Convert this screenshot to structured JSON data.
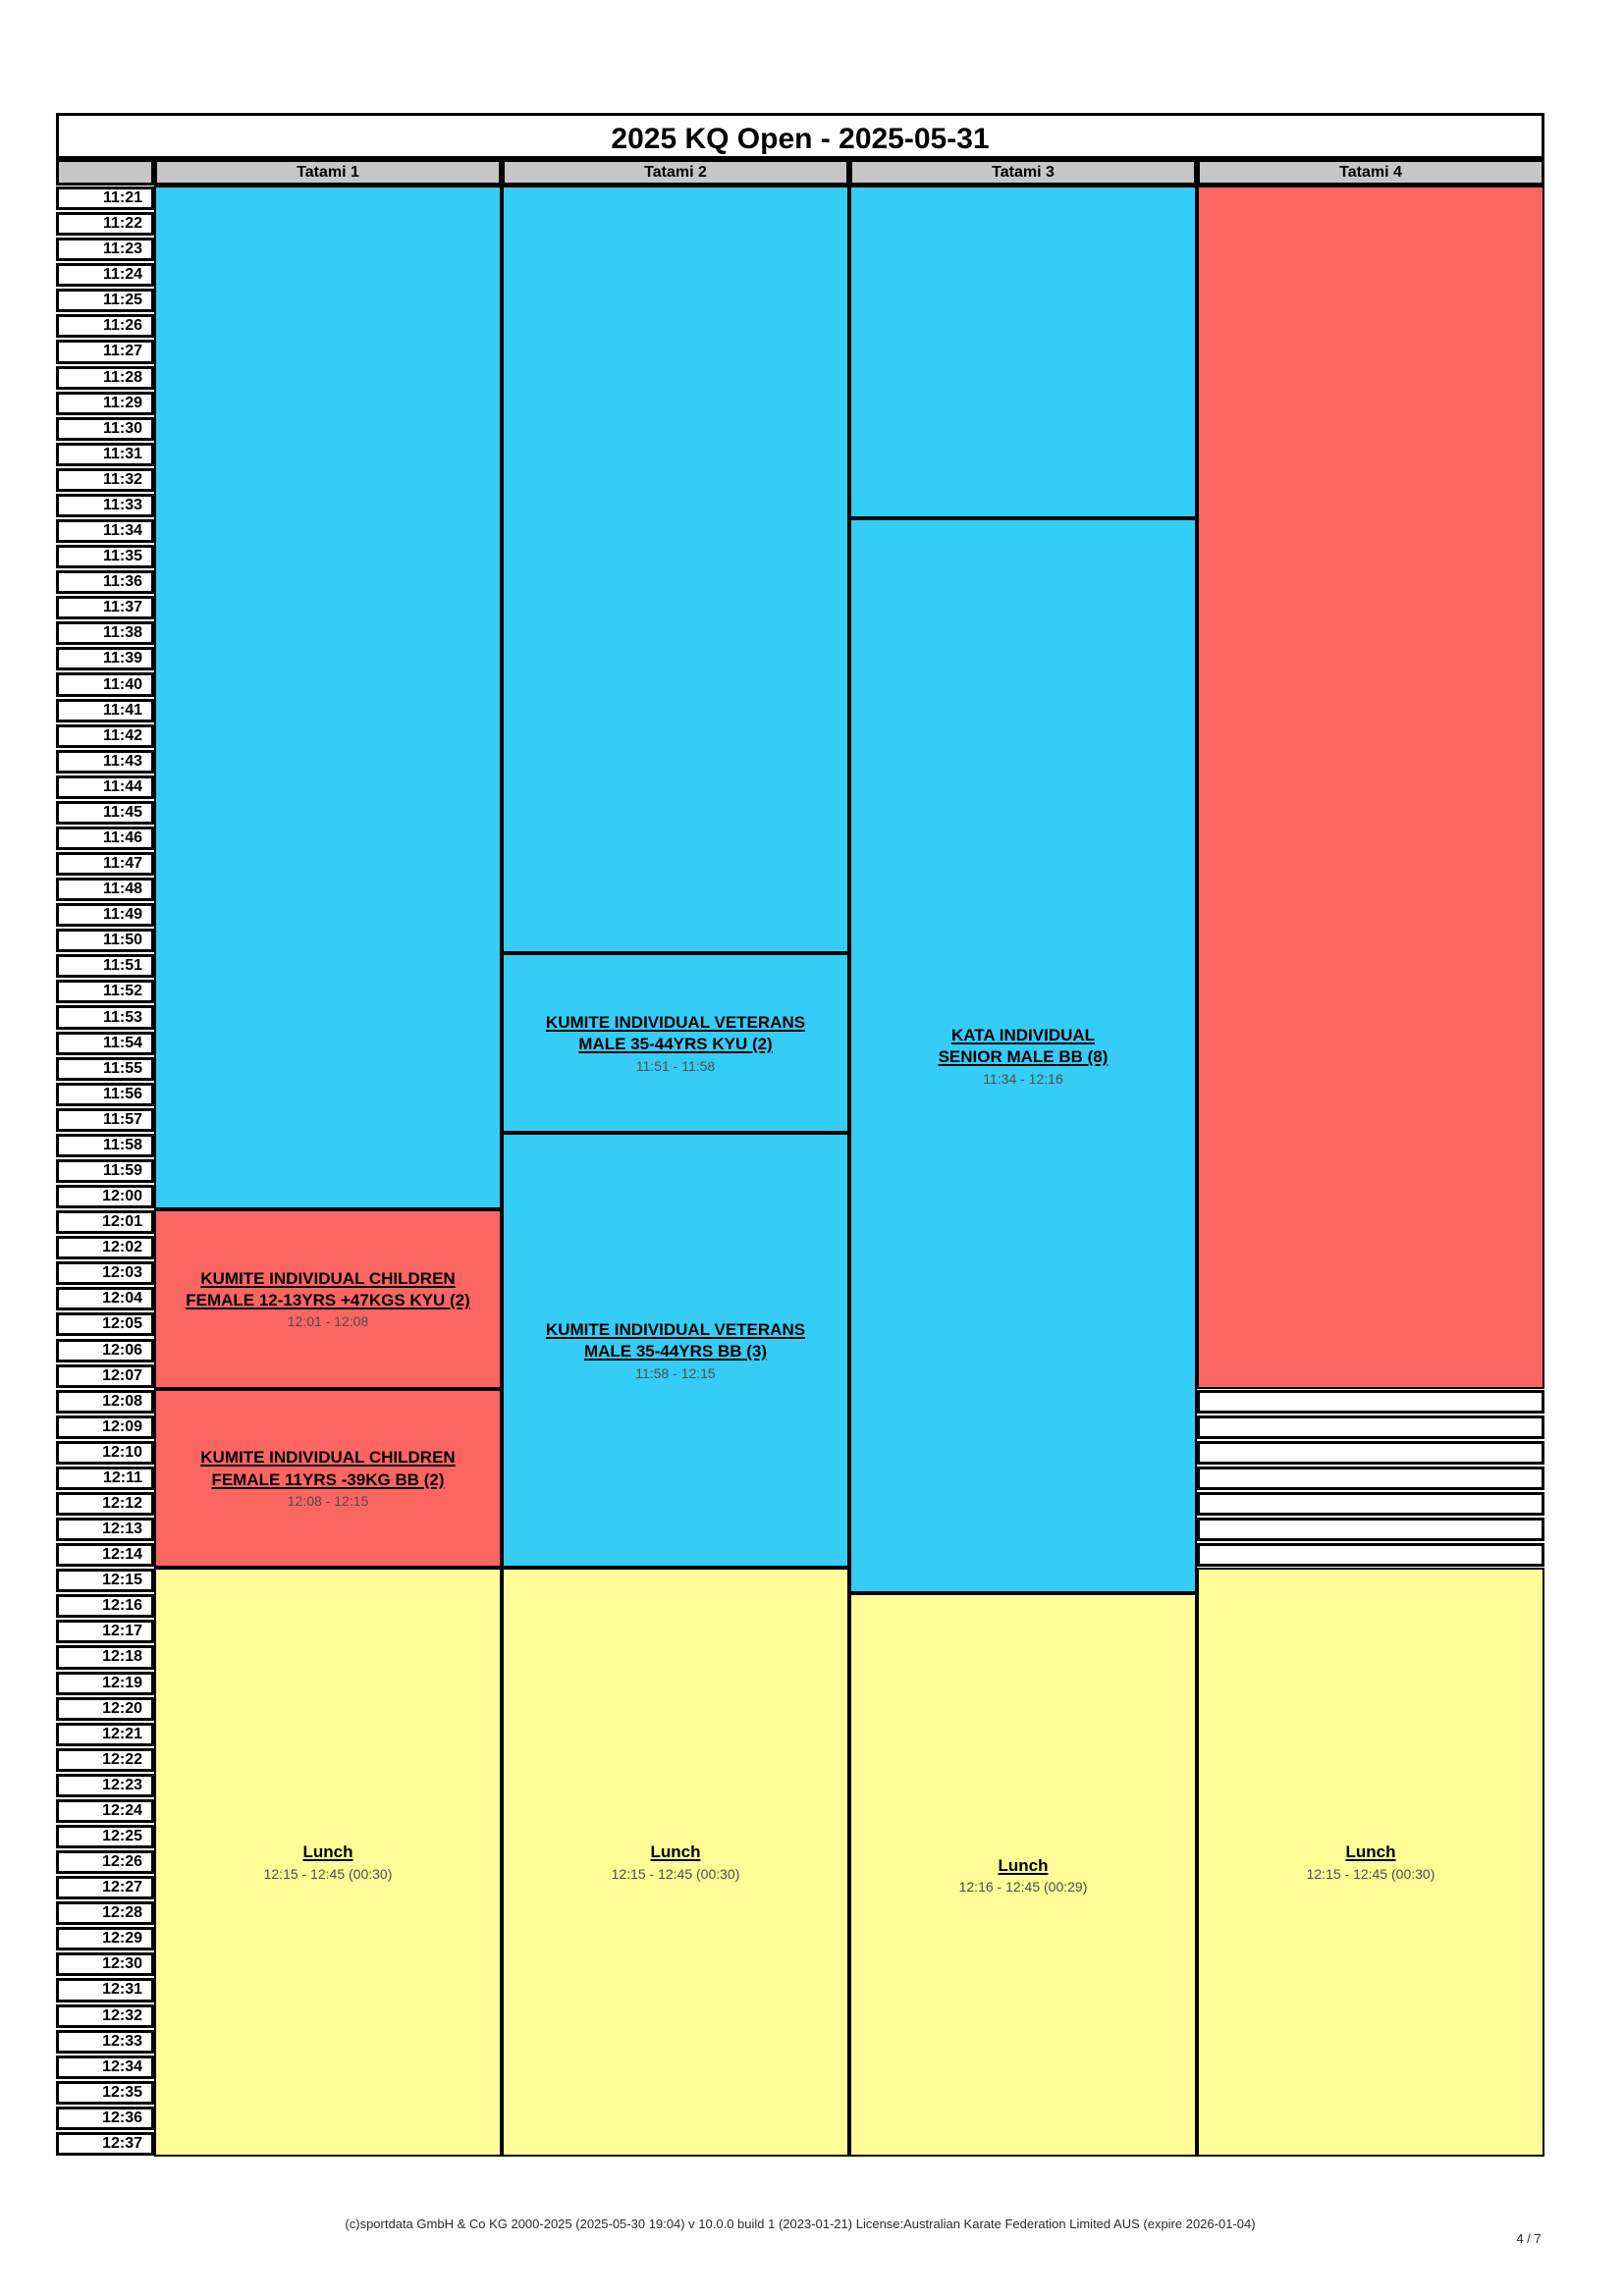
{
  "page": {
    "title": "2025 KQ Open - 2025-05-31",
    "footer": "(c)sportdata GmbH & Co KG 2000-2025 (2025-05-30 19:04) v 10.0.0 build 1 (2023-01-21) License:Australian Karate Federation Limited AUS (expire 2026-01-04)",
    "page_indicator": "4 / 7"
  },
  "palette": {
    "blue": "#35CCF5",
    "red": "#FB6662",
    "yellow": "#FEFD98",
    "header_gray": "#C6C6C6",
    "free_white": "#FFFFFF"
  },
  "schedule": {
    "time_column": {
      "slots": [
        "11:21",
        "11:22",
        "11:23",
        "11:24",
        "11:25",
        "11:26",
        "11:27",
        "11:28",
        "11:29",
        "11:30",
        "11:31",
        "11:32",
        "11:33",
        "11:34",
        "11:35",
        "11:36",
        "11:37",
        "11:38",
        "11:39",
        "11:40",
        "11:41",
        "11:42",
        "11:43",
        "11:44",
        "11:45",
        "11:46",
        "11:47",
        "11:48",
        "11:49",
        "11:50",
        "11:51",
        "11:52",
        "11:53",
        "11:54",
        "11:55",
        "11:56",
        "11:57",
        "11:58",
        "11:59",
        "12:00",
        "12:01",
        "12:02",
        "12:03",
        "12:04",
        "12:05",
        "12:06",
        "12:07",
        "12:08",
        "12:09",
        "12:10",
        "12:11",
        "12:12",
        "12:13",
        "12:14",
        "12:15",
        "12:16",
        "12:17",
        "12:18",
        "12:19",
        "12:20",
        "12:21",
        "12:22",
        "12:23",
        "12:24",
        "12:25",
        "12:26",
        "12:27",
        "12:28",
        "12:29",
        "12:30",
        "12:31",
        "12:32",
        "12:33",
        "12:34",
        "12:35",
        "12:36",
        "12:37"
      ]
    },
    "columns": [
      {
        "label": "Tatami 1",
        "events": [
          {
            "kind": "session",
            "color": "blue",
            "title_lines": [],
            "time_range": "",
            "start": "11:21",
            "end": "12:01"
          },
          {
            "kind": "session",
            "color": "red",
            "title_lines": [
              "KUMITE INDIVIDUAL CHILDREN",
              "FEMALE 12-13YRS +47KGS KYU (2)"
            ],
            "time_range": "12:01 - 12:08",
            "start": "12:01",
            "end": "12:08"
          },
          {
            "kind": "session",
            "color": "red",
            "title_lines": [
              "KUMITE INDIVIDUAL CHILDREN",
              "FEMALE 11YRS -39KG BB (2)"
            ],
            "time_range": "12:08 - 12:15",
            "start": "12:08",
            "end": "12:15"
          },
          {
            "kind": "session",
            "color": "yellow",
            "title_lines": [
              "Lunch"
            ],
            "time_range": "12:15 - 12:45 (00:30)",
            "start": "12:15",
            "end": "12:45"
          }
        ]
      },
      {
        "label": "Tatami 2",
        "events": [
          {
            "kind": "session",
            "color": "blue",
            "title_lines": [],
            "time_range": "",
            "start": "11:21",
            "end": "11:51"
          },
          {
            "kind": "session",
            "color": "blue",
            "title_lines": [
              "KUMITE INDIVIDUAL VETERANS",
              "MALE 35-44YRS KYU (2)"
            ],
            "time_range": "11:51 - 11:58",
            "start": "11:51",
            "end": "11:58"
          },
          {
            "kind": "session",
            "color": "blue",
            "title_lines": [
              "KUMITE INDIVIDUAL VETERANS",
              "MALE 35-44YRS BB (3)"
            ],
            "time_range": "11:58 - 12:15",
            "start": "11:58",
            "end": "12:15"
          },
          {
            "kind": "session",
            "color": "yellow",
            "title_lines": [
              "Lunch"
            ],
            "time_range": "12:15 - 12:45 (00:30)",
            "start": "12:15",
            "end": "12:45"
          }
        ]
      },
      {
        "label": "Tatami 3",
        "events": [
          {
            "kind": "session",
            "color": "blue",
            "title_lines": [],
            "time_range": "",
            "start": "11:21",
            "end": "11:34"
          },
          {
            "kind": "session",
            "color": "blue",
            "title_lines": [
              "KATA INDIVIDUAL",
              "SENIOR MALE BB (8)"
            ],
            "time_range": "11:34 - 12:16",
            "start": "11:34",
            "end": "12:16"
          },
          {
            "kind": "session",
            "color": "yellow",
            "title_lines": [
              "Lunch"
            ],
            "time_range": "12:16 - 12:45 (00:29)",
            "start": "12:16",
            "end": "12:45"
          }
        ]
      },
      {
        "label": "Tatami 4",
        "events": [
          {
            "kind": "session",
            "color": "red",
            "title_lines": [],
            "time_range": "",
            "start": "11:21",
            "end": "12:08"
          },
          {
            "kind": "free",
            "start": "12:08",
            "end": "12:15"
          },
          {
            "kind": "session",
            "color": "yellow",
            "title_lines": [
              "Lunch"
            ],
            "time_range": "12:15 - 12:45 (00:30)",
            "start": "12:15",
            "end": "12:45"
          }
        ]
      }
    ]
  }
}
